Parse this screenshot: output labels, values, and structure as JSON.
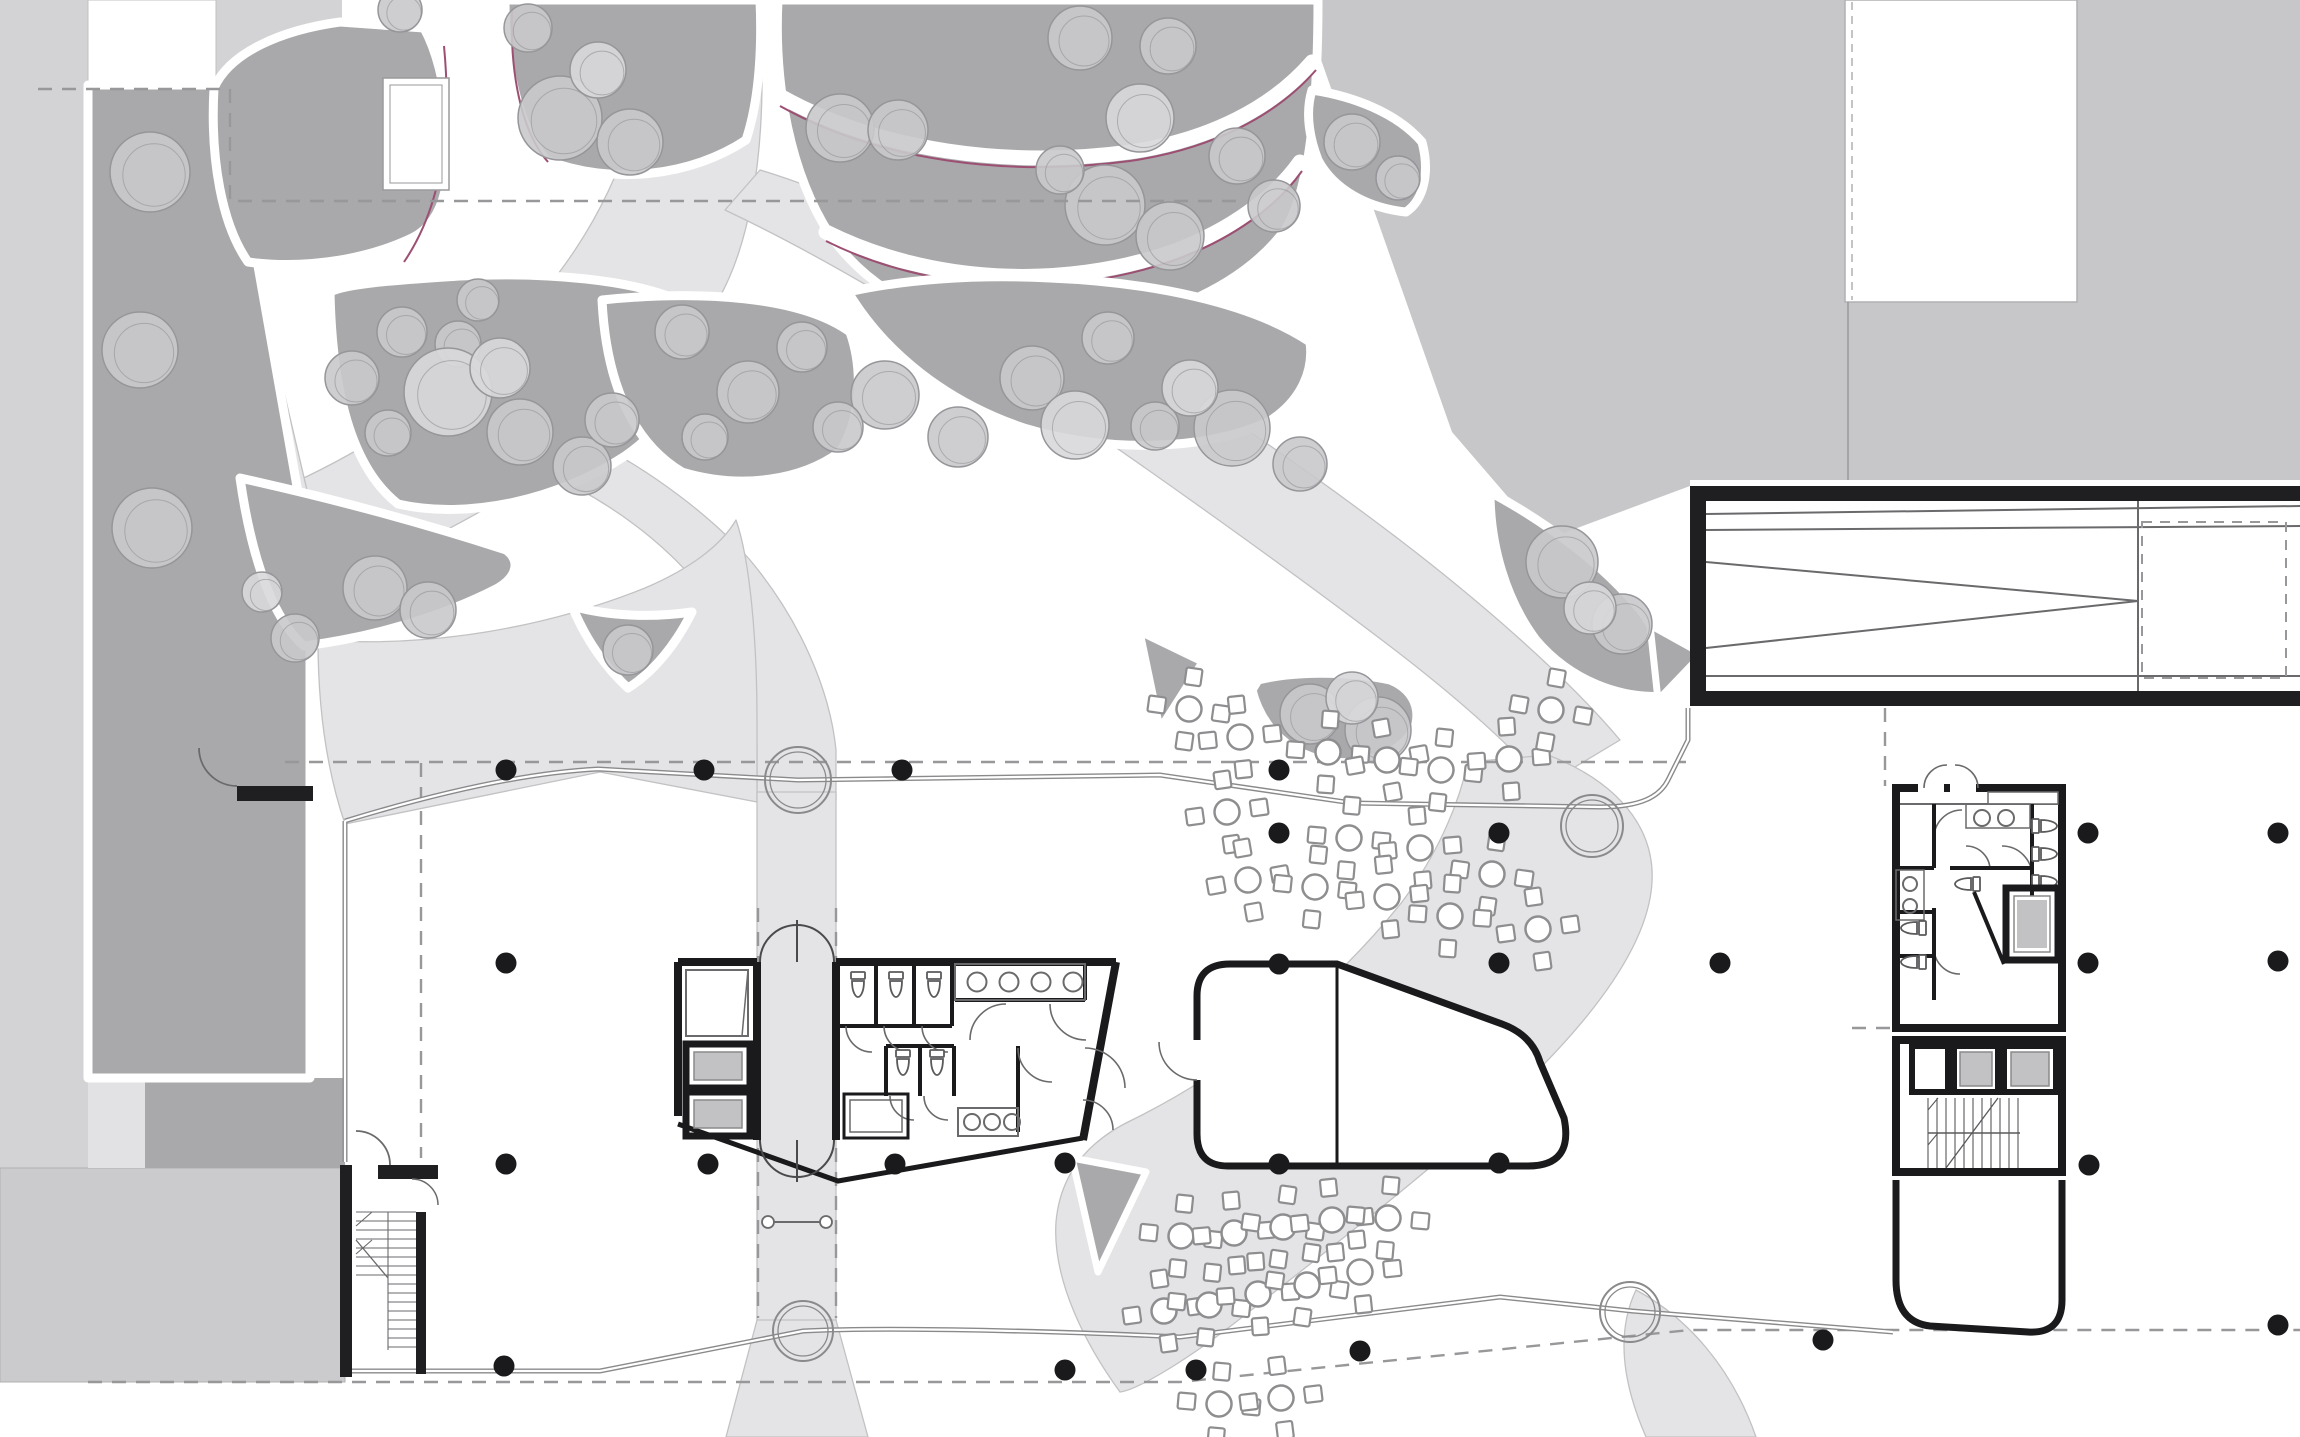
{
  "app": {
    "kind": "architectural-site-plan",
    "floor_label": ""
  },
  "palette": {
    "background": "#ffffff",
    "street": "#d3d3d5",
    "street_dark": "#c7c7c9",
    "bed": "#a9a9ab",
    "path": "#e4e4e6",
    "tree": "#c9c9cb",
    "tree_light": "#d8d8da",
    "tree_stroke": "#96969a",
    "wall": "#1a1a1c",
    "line": "#8a8a8c",
    "accent_magenta": "#9c4f72",
    "elevator_car": "#c2c2c4",
    "block_light": "#cbcbcd",
    "block_medium": "#a9a9ab",
    "block_pale": "#e2e2e4"
  },
  "counts": {
    "columns": 27,
    "cafe_tables": 28,
    "trees": 48,
    "revolving_doors": 4
  },
  "columns": [
    [
      506,
      770
    ],
    [
      704,
      770
    ],
    [
      902,
      770
    ],
    [
      1279,
      770
    ],
    [
      1279,
      833
    ],
    [
      1499,
      833
    ],
    [
      2088,
      833
    ],
    [
      2278,
      833
    ],
    [
      506,
      963
    ],
    [
      1279,
      964
    ],
    [
      1499,
      963
    ],
    [
      1720,
      963
    ],
    [
      2088,
      963
    ],
    [
      2278,
      961
    ],
    [
      506,
      1164
    ],
    [
      708,
      1164
    ],
    [
      895,
      1164
    ],
    [
      1065,
      1163
    ],
    [
      1279,
      1164
    ],
    [
      1499,
      1163
    ],
    [
      2089,
      1165
    ],
    [
      504,
      1366
    ],
    [
      1065,
      1370
    ],
    [
      1196,
      1370
    ],
    [
      1360,
      1351
    ],
    [
      1823,
      1340
    ],
    [
      2278,
      1325
    ]
  ],
  "revolving_doors": [
    [
      798,
      780,
      33
    ],
    [
      1592,
      826,
      31
    ],
    [
      803,
      1331,
      30
    ],
    [
      1630,
      1312,
      30
    ]
  ],
  "trees": [
    [
      150,
      172,
      40,
      0
    ],
    [
      140,
      350,
      38,
      0
    ],
    [
      152,
      528,
      40,
      0
    ],
    [
      375,
      588,
      32,
      0
    ],
    [
      428,
      610,
      28,
      0
    ],
    [
      295,
      638,
      24,
      0
    ],
    [
      262,
      592,
      20,
      1
    ],
    [
      400,
      10,
      22,
      0
    ],
    [
      352,
      378,
      27,
      0
    ],
    [
      402,
      332,
      25,
      0
    ],
    [
      458,
      344,
      23,
      0
    ],
    [
      478,
      300,
      21,
      0
    ],
    [
      520,
      432,
      33,
      0
    ],
    [
      582,
      466,
      29,
      0
    ],
    [
      612,
      420,
      27,
      0
    ],
    [
      388,
      433,
      23,
      0
    ],
    [
      448,
      392,
      44,
      1
    ],
    [
      500,
      368,
      30,
      1
    ],
    [
      560,
      118,
      42,
      0
    ],
    [
      630,
      142,
      33,
      0
    ],
    [
      528,
      28,
      24,
      0
    ],
    [
      598,
      70,
      28,
      1
    ],
    [
      1080,
      38,
      32,
      0
    ],
    [
      1168,
      46,
      28,
      0
    ],
    [
      1105,
      205,
      40,
      0
    ],
    [
      1170,
      236,
      34,
      0
    ],
    [
      1237,
      156,
      28,
      0
    ],
    [
      1274,
      206,
      26,
      0
    ],
    [
      1060,
      170,
      24,
      0
    ],
    [
      840,
      128,
      34,
      0
    ],
    [
      898,
      130,
      30,
      0
    ],
    [
      1140,
      118,
      34,
      1
    ],
    [
      885,
      395,
      34,
      0
    ],
    [
      958,
      437,
      30,
      0
    ],
    [
      1032,
      378,
      32,
      0
    ],
    [
      1108,
      338,
      26,
      0
    ],
    [
      1232,
      428,
      38,
      0
    ],
    [
      1300,
      464,
      27,
      0
    ],
    [
      1155,
      426,
      24,
      0
    ],
    [
      1190,
      388,
      28,
      1
    ],
    [
      1075,
      425,
      34,
      1
    ],
    [
      682,
      332,
      27,
      0
    ],
    [
      748,
      392,
      31,
      0
    ],
    [
      802,
      347,
      25,
      0
    ],
    [
      705,
      437,
      23,
      0
    ],
    [
      838,
      427,
      25,
      0
    ],
    [
      1562,
      562,
      36,
      0
    ],
    [
      1622,
      624,
      30,
      0
    ],
    [
      1590,
      608,
      26,
      1
    ],
    [
      1352,
      142,
      28,
      0
    ],
    [
      1398,
      178,
      22,
      0
    ],
    [
      628,
      650,
      25,
      0
    ],
    [
      1310,
      714,
      30,
      0
    ],
    [
      1378,
      730,
      33,
      0
    ],
    [
      1352,
      698,
      26,
      1
    ]
  ],
  "tables": [
    [
      1189,
      709,
      8
    ],
    [
      1240,
      737,
      -6
    ],
    [
      1328,
      752,
      4
    ],
    [
      1387,
      760,
      -10
    ],
    [
      1441,
      770,
      6
    ],
    [
      1509,
      759,
      -4
    ],
    [
      1551,
      710,
      10
    ],
    [
      1227,
      812,
      -8
    ],
    [
      1349,
      838,
      5
    ],
    [
      1420,
      848,
      -5
    ],
    [
      1492,
      874,
      8
    ],
    [
      1248,
      880,
      -10
    ],
    [
      1315,
      887,
      6
    ],
    [
      1387,
      897,
      -6
    ],
    [
      1450,
      916,
      4
    ],
    [
      1538,
      929,
      -8
    ],
    [
      1181,
      1236,
      6
    ],
    [
      1234,
      1233,
      -5
    ],
    [
      1283,
      1227,
      8
    ],
    [
      1332,
      1220,
      -6
    ],
    [
      1388,
      1218,
      5
    ],
    [
      1164,
      1311,
      -8
    ],
    [
      1209,
      1305,
      6
    ],
    [
      1258,
      1294,
      -4
    ],
    [
      1307,
      1285,
      8
    ],
    [
      1360,
      1272,
      -6
    ],
    [
      1219,
      1404,
      5
    ],
    [
      1281,
      1398,
      -7
    ]
  ]
}
